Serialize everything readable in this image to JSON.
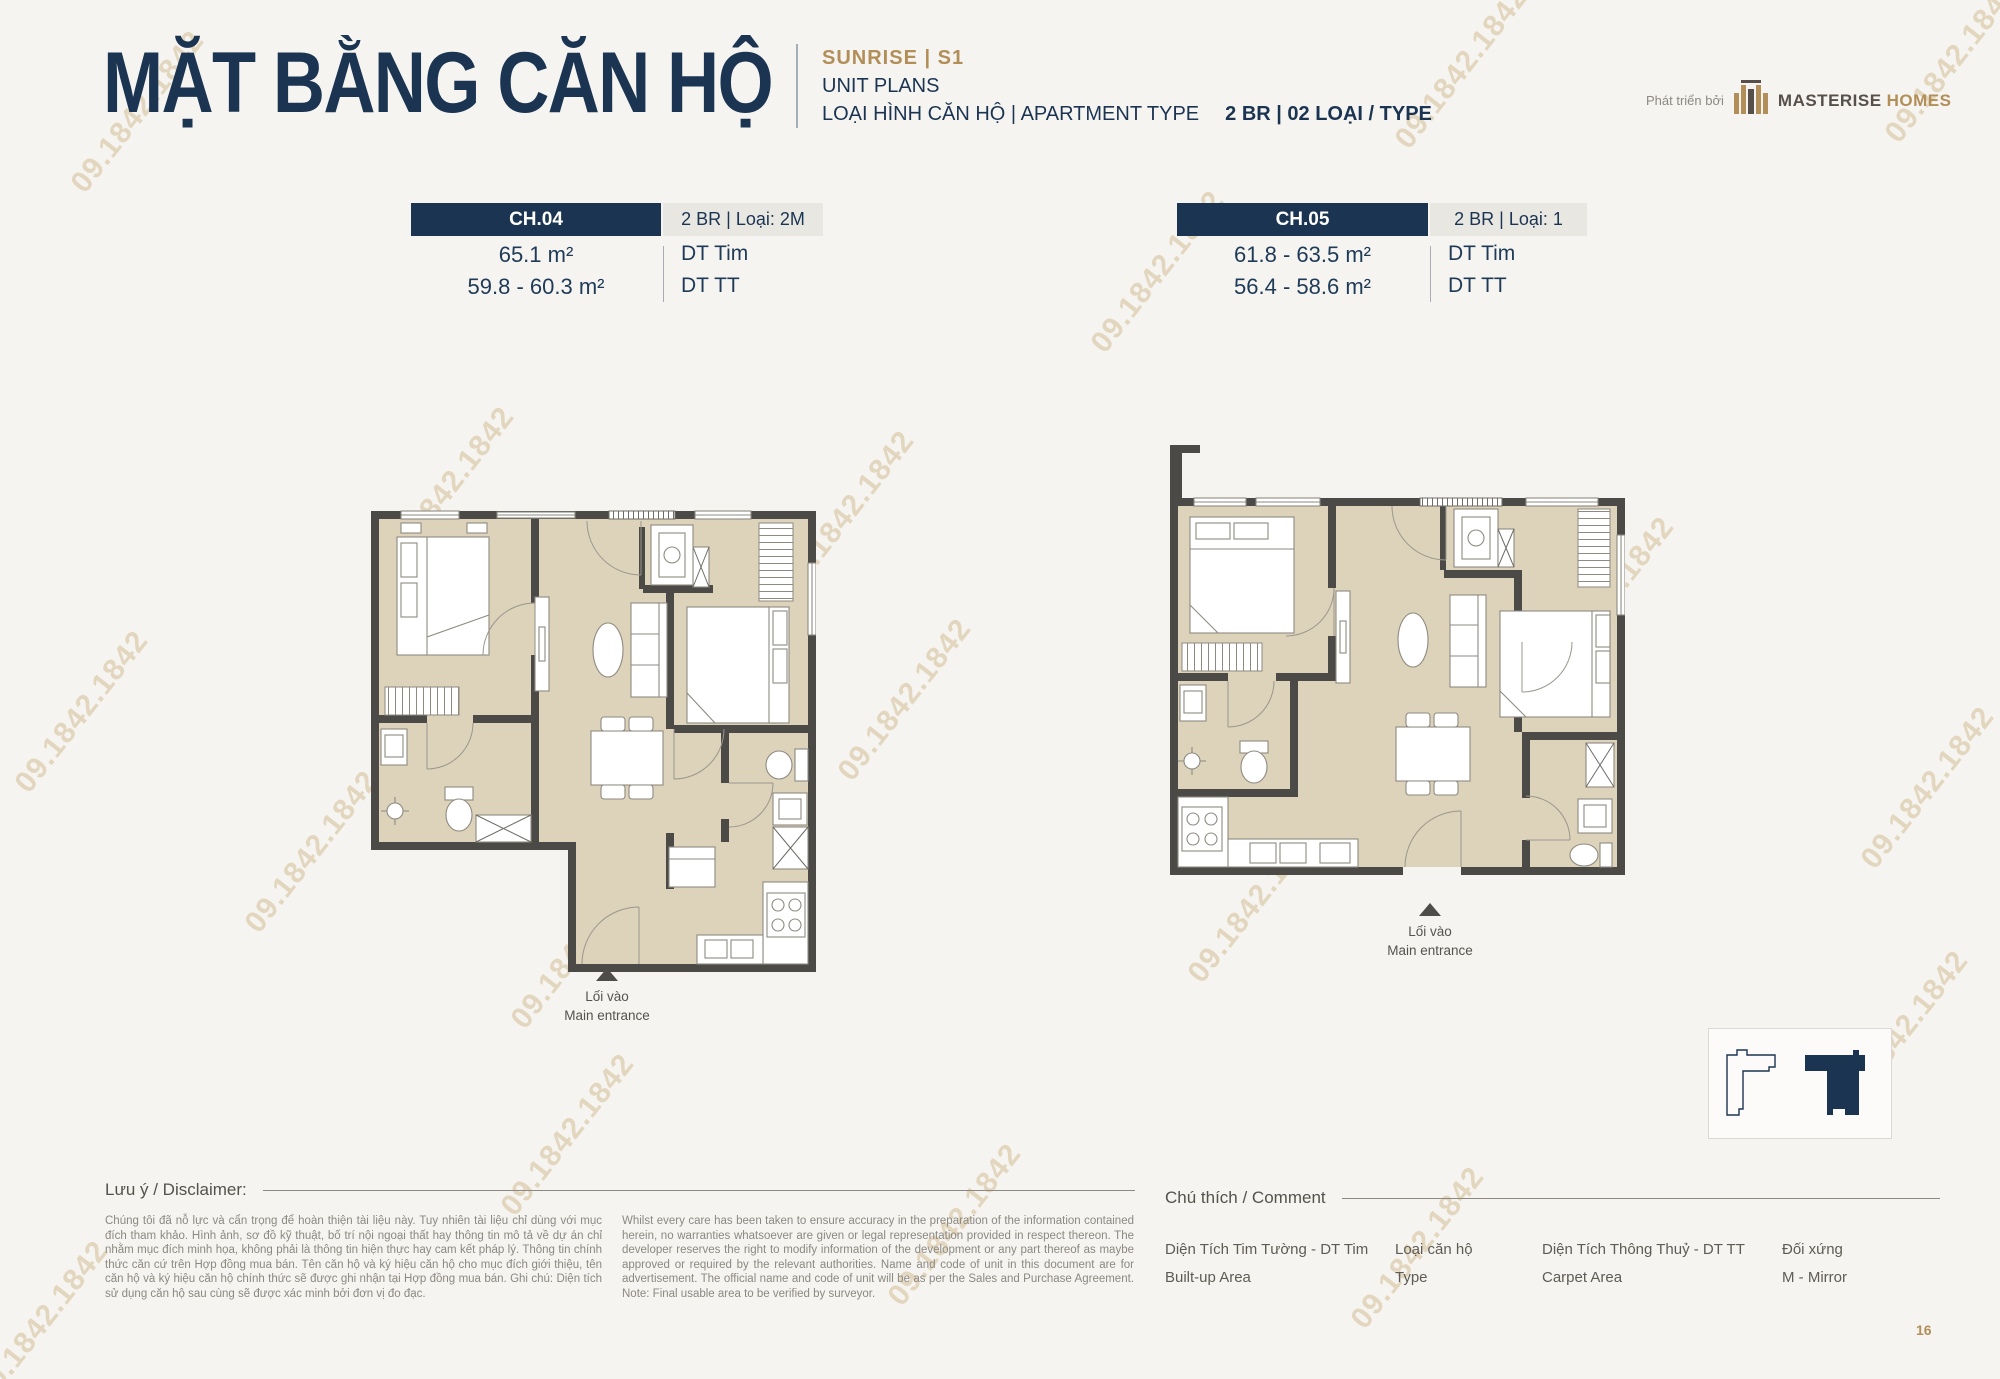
{
  "watermark": {
    "text": "09.1842.1842"
  },
  "header": {
    "title": "MẶT BẰNG CĂN HỘ",
    "project": "SUNRISE  |  S1",
    "subtitle": "UNIT PLANS",
    "type_label": "LOẠI HÌNH CĂN HỘ  |  APARTMENT TYPE",
    "type_value": "2 BR  |  02 LOẠI / TYPE",
    "developer_prefix": "Phát triển bởi",
    "brand_name": "MASTERISE",
    "brand_suffix": "HOMES"
  },
  "units": [
    {
      "code": "CH.04",
      "type": "2 BR | Loại: 2M",
      "area_built_up": "65.1 m²",
      "area_carpet": "59.8 - 60.3 m²",
      "built_up_label": "DT Tim",
      "carpet_label": "DT TT",
      "entrance_vi": "Lối vào",
      "entrance_en": "Main entrance"
    },
    {
      "code": "CH.05",
      "type": "2 BR | Loại: 1",
      "area_built_up": "61.8 - 63.5 m²",
      "area_carpet": "56.4 - 58.6 m²",
      "built_up_label": "DT Tim",
      "carpet_label": "DT TT",
      "entrance_vi": "Lối vào",
      "entrance_en": "Main entrance"
    }
  ],
  "locator": {
    "building_label": "S1"
  },
  "disclaimer": {
    "heading": "Lưu ý / Disclaimer:",
    "vi": "Chúng tôi đã nỗ lực và cẩn trọng để hoàn thiện tài liệu này. Tuy nhiên tài liệu chỉ dùng với mục đích tham khảo. Hình ảnh, sơ đồ kỹ thuật, bố trí nội ngoại thất hay thông tin mô tả về dự án chỉ nhằm mục đích minh họa, không phải là thông tin hiện thực hay cam kết pháp lý. Thông tin chính thức căn cứ trên Hợp đồng mua bán. Tên căn hộ và ký hiệu căn hộ cho mục đích giới thiệu, tên căn hộ và ký hiệu căn hộ chính thức sẽ được ghi nhận tại Hợp đồng mua bán. Ghi chú: Diện tích sử dụng căn hộ sau cùng sẽ được xác minh bởi đơn vị đo đạc.",
    "en": "Whilst every care has been taken to ensure accuracy in the preparation of the information contained herein, no warranties whatsoever are given or legal representation provided in respect thereon. The developer reserves the right to modify information of the development or any part thereof as maybe approved or required by the relevant authorities. Name and code of unit in this document are for advertisement. The official name and code of unit will be as per the Sales and Purchase Agreement. Note: Final usable area to be verified by surveyor."
  },
  "legend": {
    "heading": "Chú thích / Comment",
    "items": [
      {
        "vi": "Diện Tích Tim Tường - DT Tim",
        "en": "Built-up Area"
      },
      {
        "vi": "Loại căn hộ",
        "en": "Type"
      },
      {
        "vi": "Diện Tích Thông Thuỷ - DT TT",
        "en": "Carpet Area"
      },
      {
        "vi": "Đối xứng",
        "en": "M - Mirror"
      }
    ]
  },
  "page_number": "16"
}
